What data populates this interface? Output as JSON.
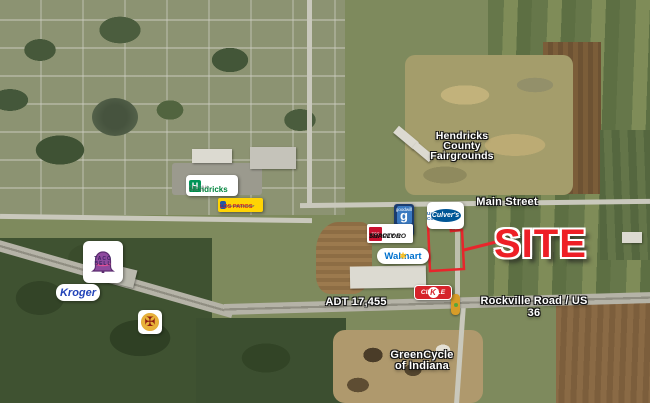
{
  "map": {
    "labels": {
      "fairgrounds": "Hendricks\nCounty\nFairgrounds",
      "main_street": "Main Street",
      "adt": "ADT 17,455",
      "rockville": "Rockville Road / US 36",
      "greencycle": "GreenCycle\nof Indiana",
      "site": "SITE"
    },
    "logos": {
      "hendricks": {
        "name": "Hendricks",
        "sub": "REGIONAL HEALTH",
        "icon_letter": "H"
      },
      "los_patios": {
        "name": "LOS PATIOS",
        "sub": "MEXICAN RESTAURANT"
      },
      "goodwill": {
        "glyph": "g",
        "name": "goodwill"
      },
      "culvers": {
        "status": "Under Construction",
        "name": "Culver's"
      },
      "tractor_supply": {
        "icon": "TSC",
        "line1": "TRACTOR",
        "line2": "SUPPLY CO"
      },
      "walmart": {
        "name": "Walmart",
        "spark": "✱"
      },
      "circle_k": {
        "word": "CIRCLE",
        "letter": "K"
      },
      "taco_bell": {
        "name": "TACO\nBELL"
      },
      "kroger": {
        "name": "Kroger"
      },
      "fire_department": {
        "emblem": "✠"
      }
    },
    "colors": {
      "site_red": "#ee1f26",
      "walmart_blue": "#0071ce",
      "walmart_yellow": "#ffc220",
      "kroger_blue": "#2243b8",
      "circle_k_red": "#d6232a",
      "tractor_supply_red": "#c8102e",
      "goodwill_navy": "#1b3c6e",
      "goodwill_blue": "#3a79c0",
      "culvers_blue": "#005696",
      "hendricks_green": "#009557",
      "los_patios_yellow": "#ffd404",
      "taco_bell_purple": "#702f8a",
      "label_text": "#ffffff"
    }
  }
}
